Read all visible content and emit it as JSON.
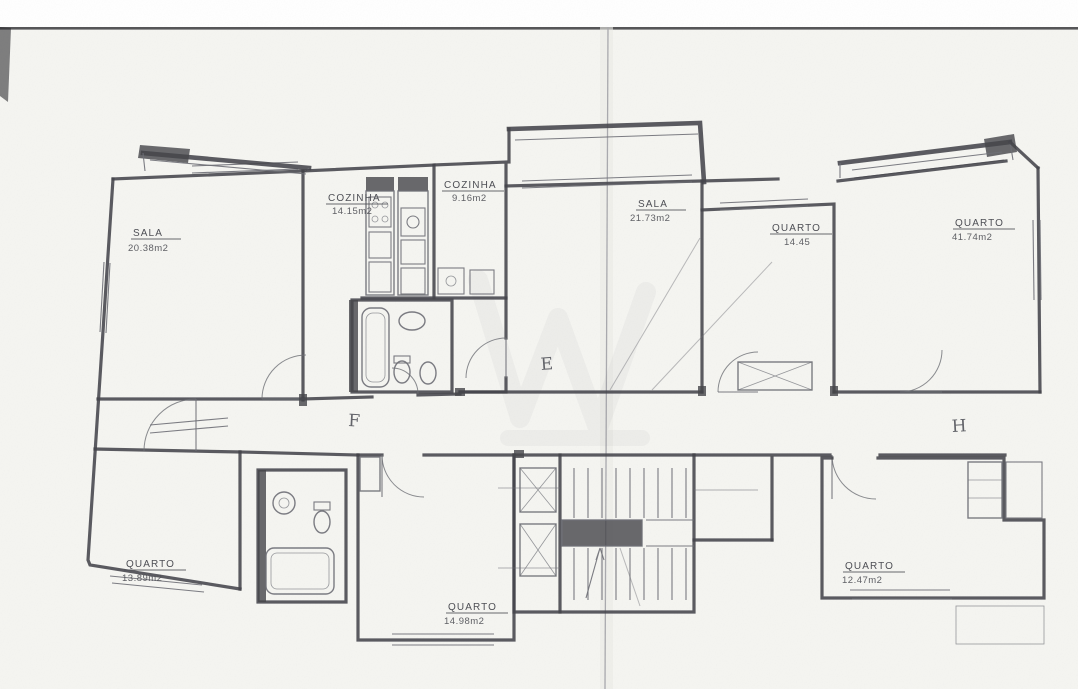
{
  "document": {
    "type": "scanned architectural floor plan",
    "language": "Portuguese"
  },
  "colors": {
    "paper": "#f5f5f1",
    "wall": "#45464b",
    "pencil": "#6e6f76",
    "label": "#4e4f55",
    "fold": "#a9a9ad",
    "scan-edge": "#2e2e32"
  },
  "labels": {
    "sala_left": {
      "name": "SALA",
      "area": "20.38m2"
    },
    "cozinha_left": {
      "name": "COZINHA",
      "area": "14.15m2"
    },
    "cozinha_right": {
      "name": "COZINHA",
      "area": "9.16m2"
    },
    "sala_center": {
      "name": "SALA",
      "area": "21.73m2"
    },
    "quarto_center_right": {
      "name": "QUARTO",
      "area": "14.45"
    },
    "quarto_top_right": {
      "name": "QUARTO",
      "area": "41.74m2"
    },
    "quarto_bottom_left": {
      "name": "QUARTO",
      "area": "13.89m2"
    },
    "quarto_bottom_center": {
      "name": "QUARTO",
      "area": "14.98m2"
    },
    "quarto_bottom_right": {
      "name": "QUARTO",
      "area": "12.47m2"
    }
  },
  "unit_letters": {
    "center": "E",
    "left": "F",
    "right": "H"
  }
}
